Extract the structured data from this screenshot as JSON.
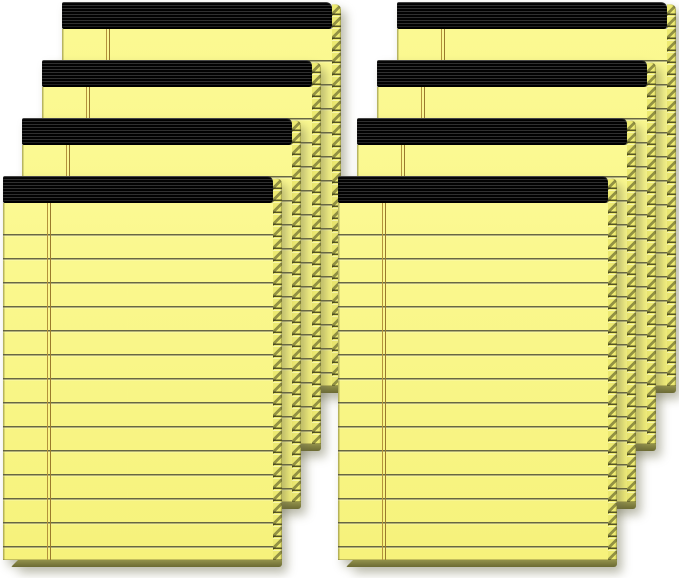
{
  "image": {
    "description": "Product photo: eight yellow ruled legal pads with black perfect-bound tops, fanned in two stacks of four on a white background",
    "background_color": "#ffffff",
    "total_pads": 8
  },
  "stacks": [
    {
      "id": "left-stack",
      "pad_count": 4
    },
    {
      "id": "right-stack",
      "pad_count": 4
    }
  ],
  "pad_style": {
    "binding_color": "#141414",
    "paper_color": "#f6f27b",
    "paper_highlight_color": "#fbf992",
    "paper_edge_color": "#edea71",
    "bottom_edge_color": "#6c6b33",
    "bottom_edge_highlight_color": "#92914b",
    "rule_line_color": "rgba(78,78,55,0.85)",
    "margin_line_color_outer": "#b4923c",
    "margin_line_color_inner": "#9a7a2c",
    "ruled_lines_per_visible_page": 14
  }
}
